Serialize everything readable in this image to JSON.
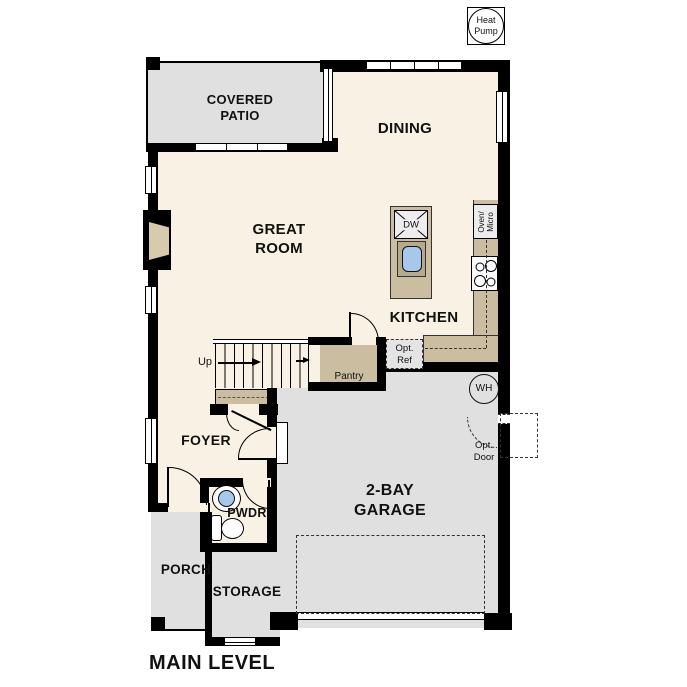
{
  "plan": {
    "title": "MAIN LEVEL",
    "rooms": {
      "covered_patio": "COVERED\nPATIO",
      "dining": "DINING",
      "great_room": "GREAT\nROOM",
      "kitchen": "KITCHEN",
      "pantry": "Pantry",
      "foyer": "FOYER",
      "powder": "PWDR",
      "garage": "2-BAY\nGARAGE",
      "porch": "PORCH",
      "storage": "STORAGE"
    },
    "stairs": {
      "up": "Up"
    },
    "equipment": {
      "heat_pump": "Heat\nPump",
      "water_heater": "WH",
      "dishwasher": "DW",
      "oven_micro": "Oven/\nMicro",
      "opt_ref": "Opt.\nRef",
      "opt_door": "Opt.\nDoor"
    }
  },
  "colors": {
    "floor": "#f9f1e4",
    "exterior_surface": "#e0e0e0",
    "cabinet": "#cbbda0",
    "sink_blue": "#a6c8ea",
    "wall": "#000000"
  }
}
